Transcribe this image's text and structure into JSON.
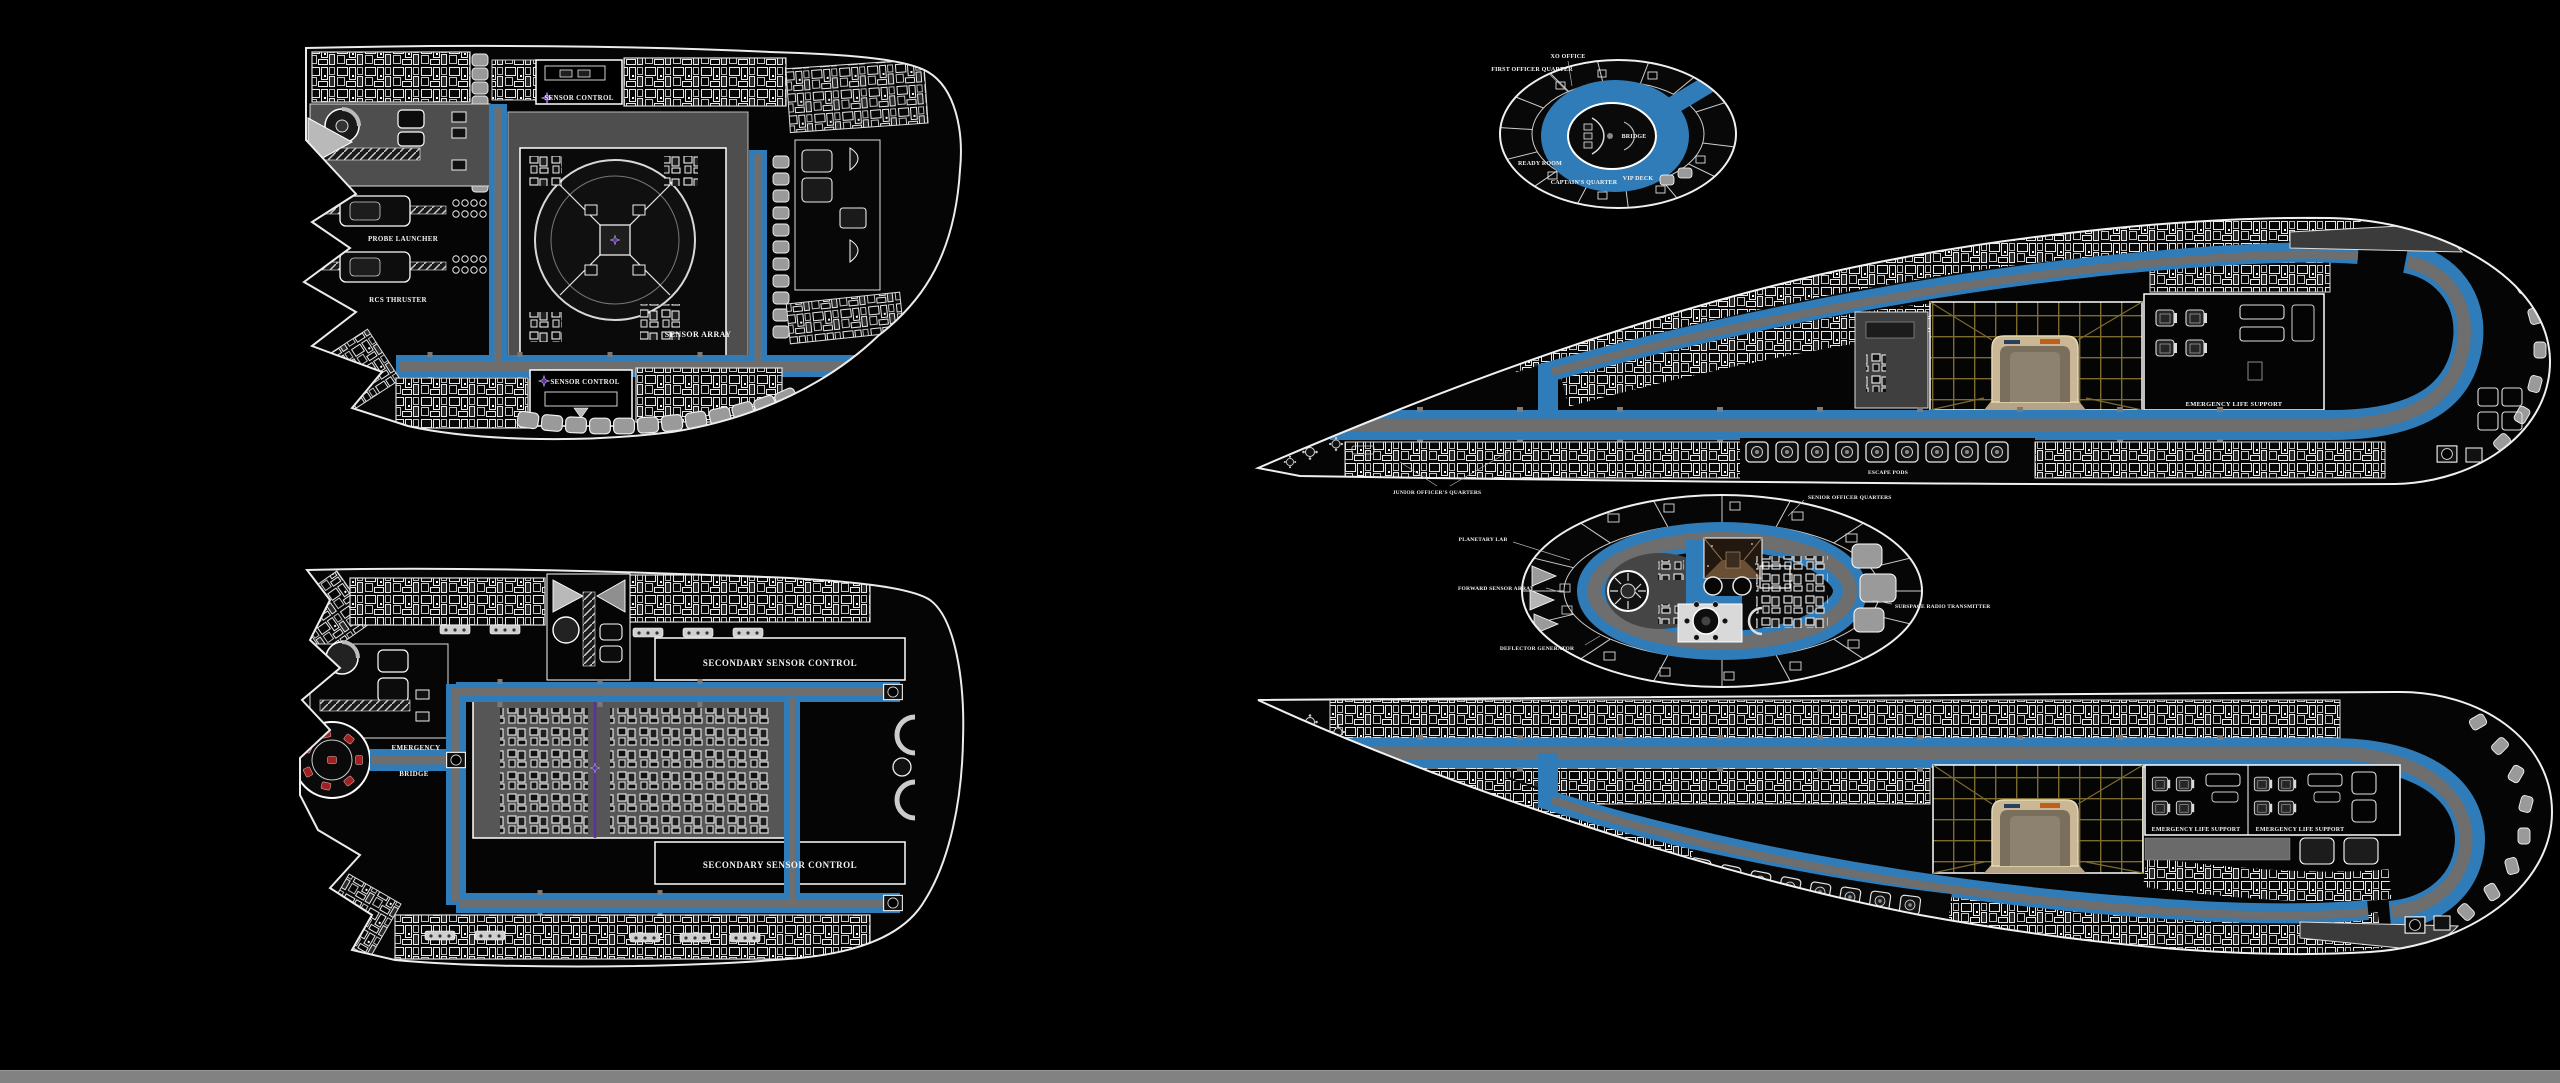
{
  "palette": {
    "background": "#000000",
    "corridor_blue": "#2f7cb8",
    "corridor_core_gray": "#6e6e6e",
    "hull_line": "#ececec",
    "room_gray": "#4e4e4e",
    "pod_gray": "#9a9a9a",
    "holodeck_grid": "#7d6a2e",
    "holodeck_arch_tan": "#c9b795",
    "accent_purple": "#5a31a0",
    "emergency_red": "#a32020",
    "bottom_bar": "#828282"
  },
  "deck_a": {
    "sensor_control_top": "SENSOR CONTROL",
    "sensor_array": "SENSOR ARRAY",
    "sensor_control_bottom": "SENSOR CONTROL",
    "probe_launcher": "PROBE LAUNCHER",
    "rcs_thruster": "RCS THRUSTER"
  },
  "deck_b": {
    "secondary_sensor_control_top": "SECONDARY SENSOR CONTROL",
    "secondary_sensor_control_bottom": "SECONDARY SENSOR CONTROL",
    "emergency": "EMERGENCY",
    "bridge": "BRIDGE"
  },
  "deck_c": {
    "first_officer_quarter": "FIRST OFFICER QUARTER",
    "xo_office": "XO OFFICE",
    "bridge": "BRIDGE",
    "ready_room": "READY ROOM",
    "captains_quarter": "CAPTAIN'S QUARTER",
    "vip_deck": "VIP DECK"
  },
  "deck_d": {
    "junior_officers_quarters": "JUNIOR OFFICER'S QUARTERS",
    "escape_pods": "ESCAPE PODS",
    "emergency_life_support": "EMERGENCY LIFE SUPPORT"
  },
  "deck_e": {
    "planetary_lab": "PLANETARY LAB",
    "forward_sensor_array": "FORWARD SENSOR ARRAY",
    "deflector_generator": "DEFLECTOR GENERATOR",
    "senior_officer_quarters": "SENIOR OFFICER QUARTERS",
    "subspace_radio_transmitter": "SUBSPACE RADIO TRANSMITTER"
  },
  "deck_f": {
    "emergency_life_support_port": "EMERGENCY LIFE SUPPORT",
    "emergency_life_support_starboard": "EMERGENCY LIFE SUPPORT"
  }
}
